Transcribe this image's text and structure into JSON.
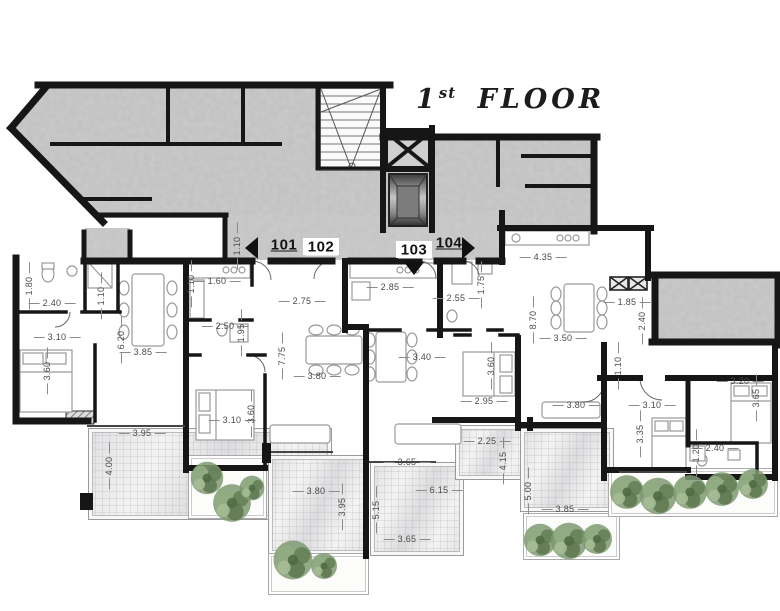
{
  "floor_plan": {
    "title": {
      "number": "1",
      "ordinal": "st",
      "name": "FLOOR"
    },
    "units": [
      "101",
      "102",
      "103",
      "104"
    ],
    "dims": [
      "1.80",
      "2.40",
      "1.10",
      "3.10",
      "3.60",
      "6.20",
      "3.85",
      "1.10",
      "1.60",
      "1.10",
      "2.50",
      "1.95",
      "2.75",
      "7.75",
      "3.80",
      "3.10",
      "3.60",
      "2.85",
      "3.40",
      "2.55",
      "1.75",
      "3.60",
      "2.95",
      "2.25",
      "4.15",
      "5.00",
      "4.35",
      "8.70",
      "3.50",
      "1.85",
      "2.40",
      "1.10",
      "3.20",
      "3.65",
      "3.80",
      "3.10",
      "3.35",
      "2.40",
      "1.20",
      "3.95",
      "4.00",
      "3.80",
      "3.95",
      "3.65",
      "6.15",
      "5.15",
      "3.65",
      "3.85"
    ]
  }
}
